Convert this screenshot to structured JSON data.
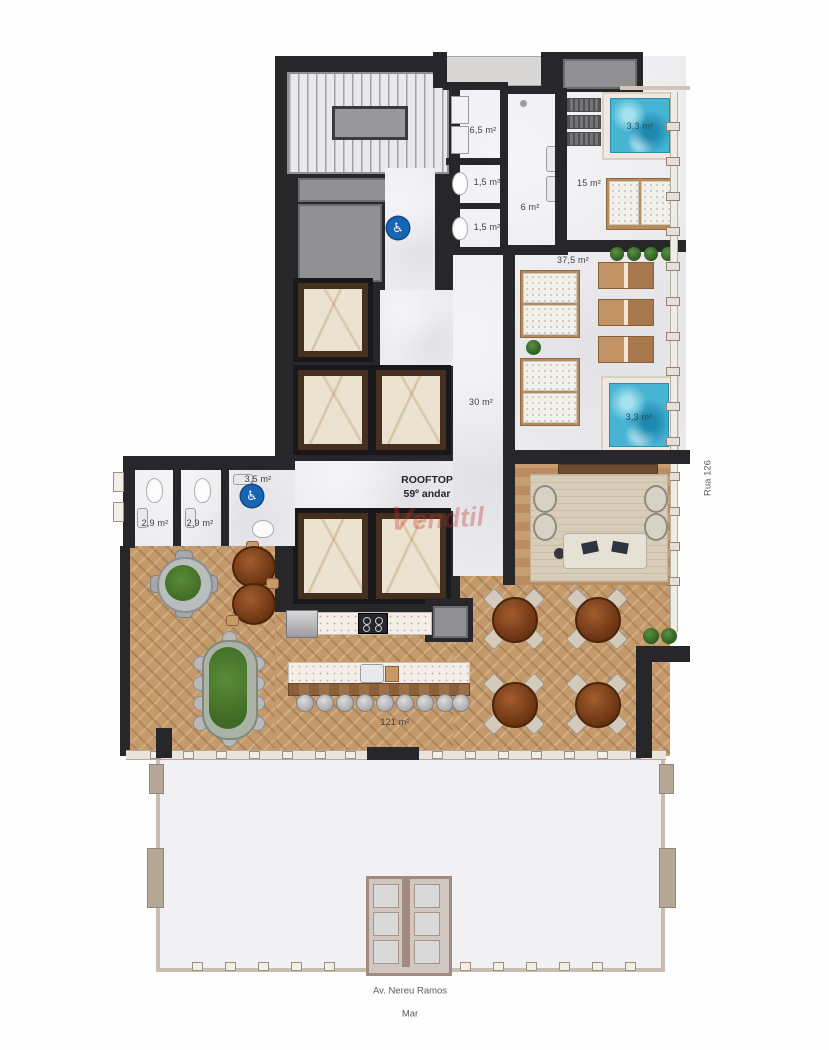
{
  "plan": {
    "title": {
      "line1": "ROOFTOP",
      "line2": "59º andar"
    },
    "watermark": "endtil",
    "areas": {
      "corridor": "6,5 m²",
      "wc1": "1,5 m²",
      "wc2": "1,5 m²",
      "hall6": "6 m²",
      "sauna": "15 m²",
      "spa1": "3,3 m²",
      "terrace": "37,5 m²",
      "hall30": "30 m²",
      "spa2": "3,3 m²",
      "wc_pcd": "3,5 m²",
      "bath1": "2,9 m²",
      "bath2": "2,9 m²",
      "salon": "121 m²"
    },
    "streets": {
      "side": "Rua 126",
      "avenue": "Av. Nereu Ramos",
      "sea": "Mar"
    },
    "icons": {
      "accessibility": "♿"
    },
    "colors": {
      "wall": "#27272a",
      "water": "#47b4d4",
      "wood": "#c49a6c",
      "accessible_blue": "#1865b3",
      "watermark_red": "#c2362b"
    }
  }
}
